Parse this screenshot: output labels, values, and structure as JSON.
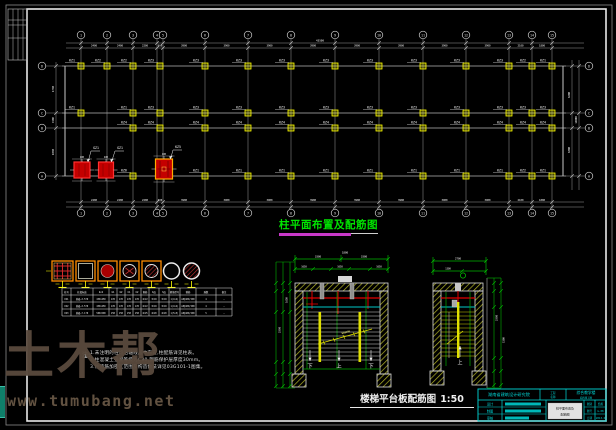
{
  "app": {
    "type": "cad-structural-drawing",
    "background": "#000000"
  },
  "titles": {
    "plan_title": "柱平面布置及配筋图",
    "plan_title_color": "#00e400",
    "underline_color": "#c838c8",
    "stair_caption": "楼梯平台板配筋图",
    "stair_scale": "1:50"
  },
  "notes": {
    "heading": "注:",
    "lines": [
      "1.未注明的柱均沿轴线居中布置,柱配筋详见柱表。",
      "2.柱混凝土强度等级为C30,钢筋保护层厚度30mm。",
      "3.柱箍筋加密区范围及构造做法详见03G101-1图集。"
    ]
  },
  "watermark": {
    "logo": "土木帮",
    "url": "www.tumubang.net",
    "logo_color": "#58493c",
    "url_color": "#645442",
    "accent_bar_color": "#0f7f6a"
  },
  "plan": {
    "grid_x": [
      81,
      107,
      133,
      157,
      163,
      205,
      248,
      291,
      335,
      379,
      423,
      466,
      509,
      532,
      552
    ],
    "axis_numbers": [
      "1",
      "2",
      "3",
      "4",
      "5",
      "6",
      "7",
      "8",
      "9",
      "10",
      "11",
      "12",
      "13",
      "14",
      "15"
    ],
    "rows_y": [
      66,
      113,
      128,
      176
    ],
    "row_letters": [
      "D",
      "C",
      "B",
      "A"
    ],
    "bay_dims": [
      "2400",
      "2400",
      "2200",
      "600",
      "3900",
      "3900",
      "3900",
      "3900",
      "3900",
      "3900",
      "3900",
      "3900",
      "2100",
      "1800"
    ],
    "total_dim": "43500",
    "left_dims": [
      "4700",
      "1500",
      "4800"
    ],
    "right_dims": [
      "6200",
      "6300",
      "14000"
    ],
    "column_rows": [
      {
        "y": 66,
        "cols": [
          {
            "x": 81,
            "t": "KZ1"
          },
          {
            "x": 107,
            "t": "KZ2"
          },
          {
            "x": 133,
            "t": "KZ2"
          },
          {
            "x": 160,
            "t": "KZ3"
          },
          {
            "x": 205,
            "t": "KZ3"
          },
          {
            "x": 248,
            "t": "KZ3"
          },
          {
            "x": 291,
            "t": "KZ3"
          },
          {
            "x": 335,
            "t": "KZ3"
          },
          {
            "x": 379,
            "t": "KZ3"
          },
          {
            "x": 423,
            "t": "KZ3"
          },
          {
            "x": 466,
            "t": "KZ3"
          },
          {
            "x": 509,
            "t": "KZ3"
          },
          {
            "x": 532,
            "t": "KZ2"
          },
          {
            "x": 552,
            "t": "KZ1"
          }
        ]
      },
      {
        "y": 113,
        "cols": [
          {
            "x": 81,
            "t": "KZ1"
          },
          {
            "x": 133,
            "t": "KZ1"
          },
          {
            "x": 160,
            "t": "KZ3"
          },
          {
            "x": 205,
            "t": "KZ3"
          },
          {
            "x": 248,
            "t": "KZ3"
          },
          {
            "x": 291,
            "t": "KZ3"
          },
          {
            "x": 335,
            "t": "KZ3"
          },
          {
            "x": 379,
            "t": "KZ3"
          },
          {
            "x": 423,
            "t": "KZ3"
          },
          {
            "x": 466,
            "t": "KZ3"
          },
          {
            "x": 509,
            "t": "KZ3"
          },
          {
            "x": 532,
            "t": "KZ3"
          },
          {
            "x": 552,
            "t": "KZ3"
          }
        ]
      },
      {
        "y": 128,
        "cols": [
          {
            "x": 133,
            "t": "KZ4"
          },
          {
            "x": 160,
            "t": "KZ4"
          },
          {
            "x": 205,
            "t": "KZ4"
          },
          {
            "x": 248,
            "t": "KZ4"
          },
          {
            "x": 291,
            "t": "KZ4"
          },
          {
            "x": 335,
            "t": "KZ4"
          },
          {
            "x": 379,
            "t": "KZ4"
          },
          {
            "x": 423,
            "t": "KZ4"
          },
          {
            "x": 466,
            "t": "KZ4"
          },
          {
            "x": 509,
            "t": "KZ4"
          },
          {
            "x": 532,
            "t": "KZ4"
          },
          {
            "x": 552,
            "t": "KZ4"
          }
        ]
      },
      {
        "y": 176,
        "cols": [
          {
            "x": 133,
            "t": "KZ6"
          },
          {
            "x": 205,
            "t": "KZ1"
          },
          {
            "x": 248,
            "t": "KZ1"
          },
          {
            "x": 291,
            "t": "KZ1"
          },
          {
            "x": 335,
            "t": "KZ1"
          },
          {
            "x": 379,
            "t": "KZ1"
          },
          {
            "x": 423,
            "t": "KZ1"
          },
          {
            "x": 466,
            "t": "KZ1"
          },
          {
            "x": 509,
            "t": "KZ1"
          },
          {
            "x": 532,
            "t": "KZ2"
          },
          {
            "x": 552,
            "t": "KZ1"
          }
        ]
      }
    ],
    "red_columns": [
      {
        "x": 82,
        "y": 170,
        "w": 16,
        "h": 16,
        "label": "GZ1",
        "style": "red"
      },
      {
        "x": 106,
        "y": 170,
        "w": 15,
        "h": 16,
        "label": "GZ1",
        "style": "red"
      },
      {
        "x": 164,
        "y": 169,
        "w": 17,
        "h": 20,
        "label": "KZ5",
        "style": "orange"
      }
    ]
  },
  "sections": {
    "types": [
      "grid-square",
      "hollow-square",
      "filled-circle-square",
      "outline-circle-square",
      "hatch-circle-square",
      "outline-circle",
      "hatch-circle"
    ],
    "x_list": [
      52,
      76,
      98,
      120,
      142,
      163,
      183
    ],
    "widths": [
      21,
      19,
      19,
      19,
      19,
      17,
      17
    ]
  },
  "schedule": {
    "x_bounds": [
      62,
      71,
      93,
      109,
      117,
      125,
      133,
      141,
      149,
      159,
      169,
      180,
      196,
      216,
      232
    ],
    "y_bounds": [
      288,
      295,
      302,
      309,
      316
    ],
    "headers": [
      "柱号",
      "柱段标高",
      "b×h",
      "b1",
      "b2",
      "h1",
      "h2",
      "角筋",
      "b边",
      "h边",
      "箍筋型号",
      "箍筋",
      "肢数",
      "备注"
    ],
    "rows": [
      [
        "KZ1",
        "基础~3.570",
        "450×450",
        "225",
        "225",
        "225",
        "225",
        "4C22",
        "3C18",
        "3C18",
        "1(4×4)",
        "A8@100/200",
        "4",
        "—"
      ],
      [
        "KZ2",
        "基础~3.570",
        "450×450",
        "225",
        "225",
        "225",
        "225",
        "4C22",
        "3C18",
        "3C18",
        "1(4×4)",
        "A8@100/200",
        "4",
        "—"
      ],
      [
        "KZ3",
        "基础~7.170",
        "500×500",
        "250",
        "250",
        "250",
        "250",
        "4C25",
        "4C20",
        "4C20",
        "1(5×5)",
        "A8@100/200",
        "5",
        "—"
      ]
    ]
  },
  "stairs": {
    "left": {
      "flow_labels": [
        "下",
        "上",
        "下"
      ],
      "top_dims_row1": [
        "3300",
        "3300"
      ],
      "top_dims_row2": [
        "1650",
        "1650",
        "1650"
      ],
      "side_dims": [
        "3300",
        "1650"
      ],
      "top_label": "1800",
      "bar_note": "B8@200"
    },
    "right": {
      "flow_label": "上",
      "top_dims_row1": [
        "2700"
      ],
      "top_dims_row2": [
        "1300"
      ],
      "side_dims": [
        "3300",
        "1500"
      ]
    }
  },
  "title_block": {
    "color": "#00d8d8",
    "org": "湖南省建筑设计研究院",
    "project_label_1": "工程",
    "project_label_2": "名称",
    "project": "综合教学楼",
    "project_sub": "结构施工图",
    "roles": [
      "设计",
      "制图",
      "审核"
    ],
    "stamp_lines": [
      "柱平面布置及",
      "配筋图"
    ],
    "mini_rows": [
      [
        "图别",
        "结施"
      ],
      [
        "图号",
        "G-08"
      ],
      [
        "日期",
        "2013.6"
      ]
    ]
  }
}
